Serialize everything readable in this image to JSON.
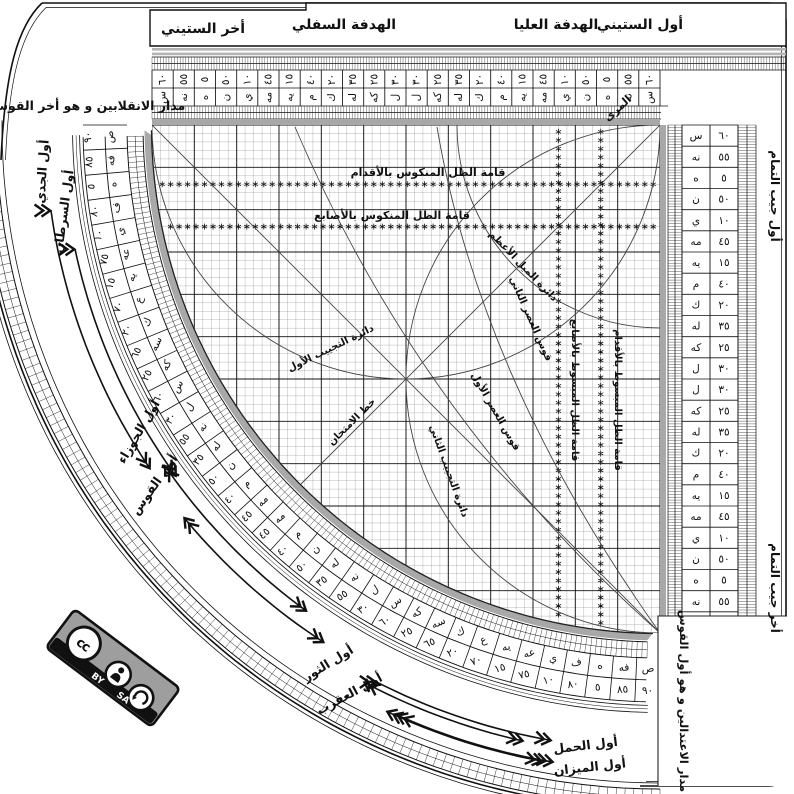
{
  "frame": {
    "tabs": {
      "awwal_sittini": "أول الستيني",
      "hadafa_ulya": "الهدفة العليا",
      "hadafa_sufla": "الهدفة السفلي",
      "akhir_sittini": "أخر الستيني"
    },
    "muri": "المرى",
    "solstice_note": "مدار الانقلابين و هو أخر القوس",
    "equinox_note": "مدار الاعتدالين و هو أول القوس",
    "cosine_start": "أول جيب التمام",
    "cosine_end": "أخر جيب التمام"
  },
  "grid_labels": {
    "mankus_aqdam": "قامة الظل المنكوس بالأقدام",
    "mankus_asabi": "قامة الظل المنكوس بالأصابع",
    "mabsut_asabi": "قامة الظل المبسوط بالأصابع",
    "mabsut_aqdam": "قامة الظل المبسوط بالأقدام",
    "mayl_azam": "دائرة الميل الأعظم",
    "asr_thani": "قوس العصر الثاني",
    "asr_awwal": "قوس العصر الأول",
    "tajyib_awwal": "دائرة التجييب الأول",
    "tajyib_thani": "دائرة التجييب الثاني",
    "imtihan": "خط الامتحان"
  },
  "zodiac": [
    {
      "label": "أول الجدي"
    },
    {
      "label": "أول السرطان"
    },
    {
      "label": "أول الجوزاء"
    },
    {
      "label": "أول القوس"
    },
    {
      "label": "أول الثور"
    },
    {
      "label": "أول العقرب"
    },
    {
      "label": "أول الحمل"
    },
    {
      "label": "أول الميزان"
    }
  ],
  "scales": {
    "linear_hindu": [
      "٦٠",
      "٥٥",
      "٥",
      "٥٠",
      "١٠",
      "٤٥",
      "١٥",
      "٤٠",
      "٢٠",
      "٣٥",
      "٢٥",
      "٣٠",
      "٣٠",
      "٢٥",
      "٣٥",
      "٢٠",
      "٤٠",
      "١٥",
      "٤٥",
      "١٠",
      "٥٠",
      "٥",
      "٥٥",
      "٦٠"
    ],
    "linear_abjad": [
      "س",
      "نه",
      "ه",
      "ن",
      "ي",
      "مه",
      "يه",
      "م",
      "ك",
      "له",
      "كه",
      "ل",
      "ل",
      "كه",
      "له",
      "ك",
      "م",
      "يه",
      "مه",
      "ي",
      "ن",
      "ه",
      "نه",
      "س"
    ],
    "arc_hindu": [
      "٩٠",
      "٨٥",
      "٥",
      "٨٠",
      "١٠",
      "٧٥",
      "١٥",
      "٧٠",
      "٢٠",
      "٦٥",
      "٢٥",
      "٦٠",
      "٣٠",
      "٥٥",
      "٣٥",
      "٥٠",
      "٤٠",
      "٤٥",
      "٤٥",
      "٤٠",
      "٥٠",
      "٣٥",
      "٥٥",
      "٣٠",
      "٦٠",
      "٢٥",
      "٦٥",
      "٢٠",
      "٧٠",
      "١٥",
      "٧٥",
      "١٠",
      "٨٠",
      "٥",
      "٨٥",
      "٩٠"
    ],
    "arc_abjad": [
      "ص",
      "فه",
      "ه",
      "ف",
      "ي",
      "عه",
      "يه",
      "ع",
      "ك",
      "سه",
      "كه",
      "س",
      "ل",
      "نه",
      "له",
      "ن",
      "م",
      "مه",
      "مه",
      "م",
      "ن",
      "له",
      "نه",
      "ل",
      "س",
      "كه",
      "سه",
      "ك",
      "ع",
      "يه",
      "عه",
      "ي",
      "ف",
      "ه",
      "فه",
      "ص"
    ]
  },
  "badge": {
    "by": "BY",
    "sa": "SA"
  },
  "colors": {
    "band_gray": "#a8a8a8",
    "plaque_gray": "#9e9e9e",
    "ink": "#1a1a1a"
  }
}
